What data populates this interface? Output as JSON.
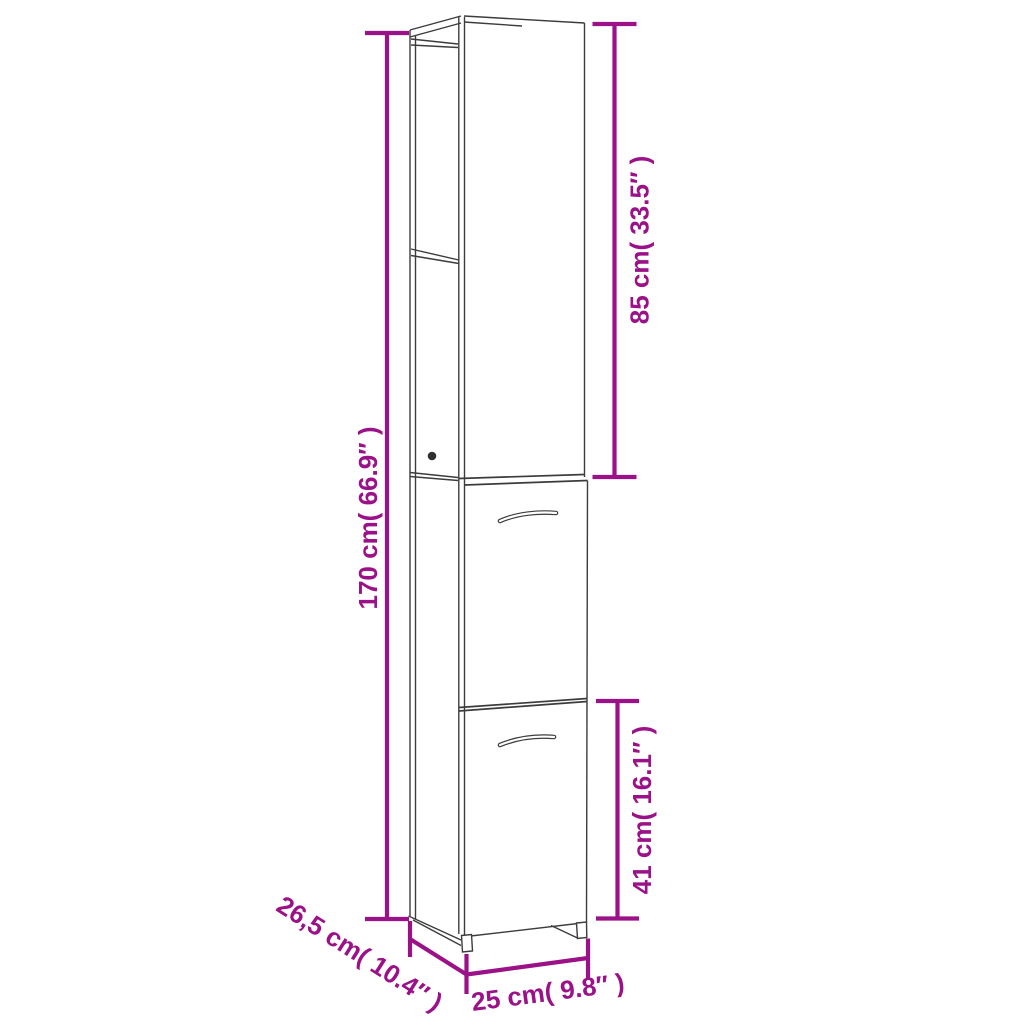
{
  "meta": {
    "background": "#ffffff",
    "accent_color": "#9B1188",
    "line_color": "#3C3C3C",
    "knob_color": "#303030"
  },
  "diagram": {
    "kind": "product-dimension-line-drawing",
    "object": "tall-narrow-cabinet-with-open-shelves-and-two-doors",
    "labels": {
      "total_height": "170 cm( 66.9″ )",
      "upper_section_height": "85 cm( 33.5″ )",
      "lower_door_height": "41 cm( 16.1″ )",
      "depth": "26,5 cm( 10.4″ )",
      "width": "25 cm( 9.8″ )"
    }
  }
}
